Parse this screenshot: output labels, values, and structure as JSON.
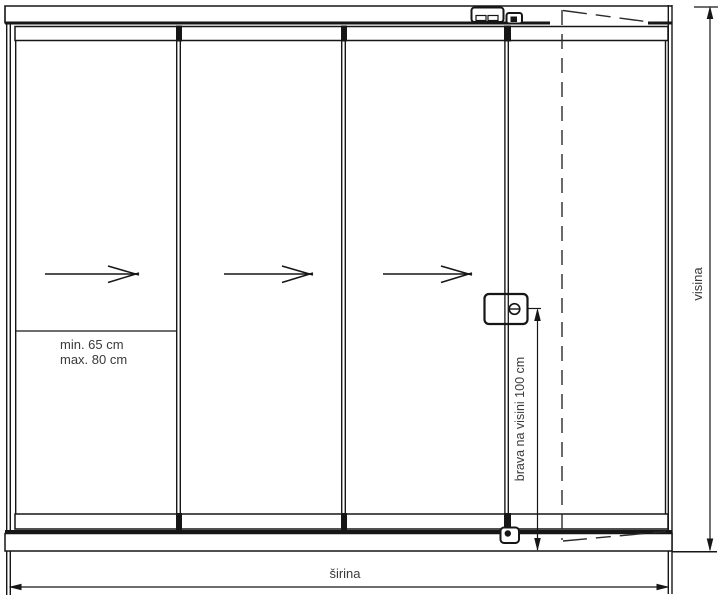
{
  "diagram": {
    "type": "technical-drawing",
    "subject": "sliding-glass-wall-with-lockable-door",
    "labels": {
      "panel_min_width": "min. 65 cm",
      "panel_max_width": "max. 80 cm",
      "width_dimension": "širina",
      "height_dimension": "visina",
      "lock_height": "brava na visini 100 cm"
    },
    "panels": {
      "count": 4,
      "sliding_panels_with_arrows": 3,
      "slide_direction": "right"
    },
    "colors": {
      "line": "#161616",
      "text": "#3a3a3a",
      "background": "#ffffff"
    }
  }
}
